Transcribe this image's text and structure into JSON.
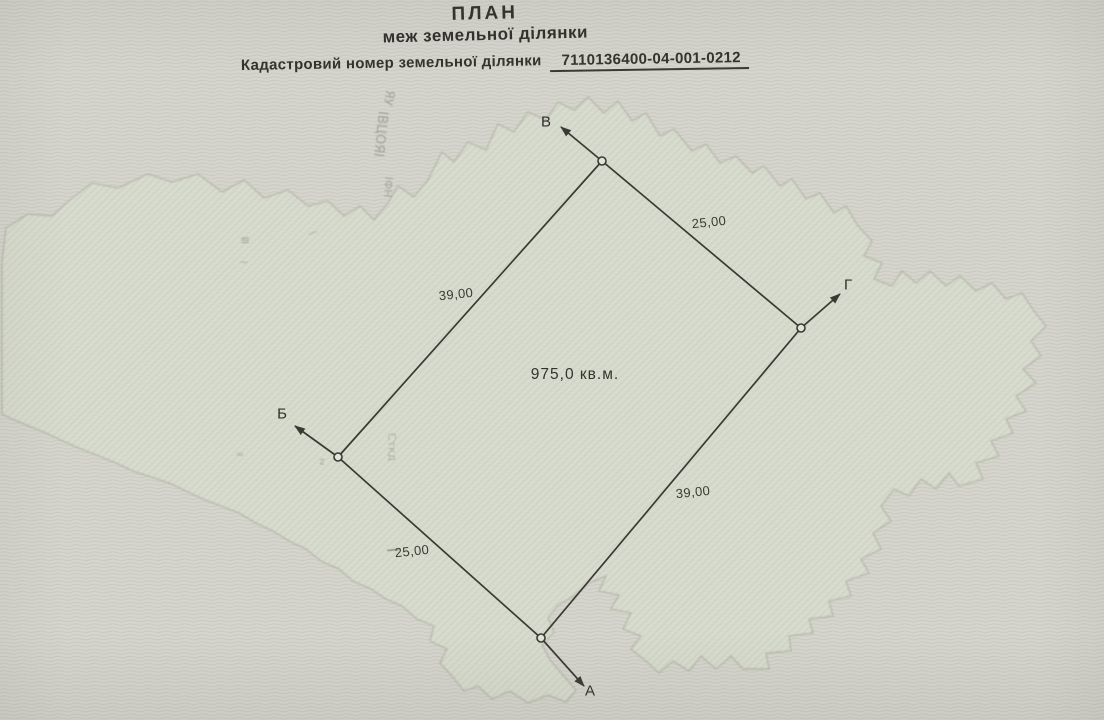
{
  "header": {
    "title": "ПЛАН",
    "subtitle": "меж земельної ділянки",
    "cadastral_label": "Кадастровий номер земельної ділянки",
    "cadastral_number": "7110136400-04-001-0212"
  },
  "plan": {
    "points": [
      {
        "name": "В",
        "x": 602,
        "y": 161,
        "arrow": {
          "x": 561,
          "y": 127
        },
        "label": {
          "x": 546,
          "y": 122
        }
      },
      {
        "name": "Г",
        "x": 801,
        "y": 328,
        "arrow": {
          "x": 840,
          "y": 294
        },
        "label": {
          "x": 848,
          "y": 285
        }
      },
      {
        "name": "А",
        "x": 541,
        "y": 638,
        "arrow": {
          "x": 584,
          "y": 686
        },
        "label": {
          "x": 590,
          "y": 691
        }
      },
      {
        "name": "Б",
        "x": 338,
        "y": 457,
        "arrow": {
          "x": 295,
          "y": 426
        },
        "label": {
          "x": 282,
          "y": 414
        }
      }
    ],
    "side_labels": [
      {
        "text": "39,00",
        "x": 456,
        "y": 294
      },
      {
        "text": "25,00",
        "x": 709,
        "y": 222
      },
      {
        "text": "39,00",
        "x": 693,
        "y": 492
      },
      {
        "text": "25,00",
        "x": 412,
        "y": 551
      }
    ],
    "area": {
      "text": "975,0 кв.м.",
      "x": 575,
      "y": 375
    }
  },
  "scan_artifacts": [
    {
      "text": "ЯУ",
      "x": 389,
      "y": 98,
      "rotate": 100,
      "size": 12,
      "opacity": 0.5
    },
    {
      "text": "ІВЦОЯІ",
      "x": 380,
      "y": 134,
      "rotate": 96,
      "size": 13,
      "opacity": 0.5
    },
    {
      "text": "ІФН",
      "x": 388,
      "y": 187,
      "rotate": 94,
      "size": 11,
      "opacity": 0.45
    },
    {
      "text": "Сткд",
      "x": 392,
      "y": 447,
      "rotate": 88,
      "size": 11,
      "opacity": 0.4
    },
    {
      "text": "≡",
      "x": 245,
      "y": 240,
      "rotate": 0,
      "size": 12,
      "opacity": 0.5
    },
    {
      "text": "—",
      "x": 313,
      "y": 233,
      "rotate": -20,
      "size": 10,
      "opacity": 0.45
    },
    {
      "text": "~",
      "x": 244,
      "y": 262,
      "rotate": 0,
      "size": 11,
      "opacity": 0.4
    },
    {
      "text": "≈",
      "x": 240,
      "y": 455,
      "rotate": 0,
      "size": 10,
      "opacity": 0.4
    },
    {
      "text": "z",
      "x": 322,
      "y": 462,
      "rotate": 0,
      "size": 10,
      "opacity": 0.45
    },
    {
      "text": "—",
      "x": 393,
      "y": 550,
      "rotate": -4,
      "size": 13,
      "opacity": 0.8,
      "color": "#45453f"
    }
  ],
  "colors": {
    "paper": "#d6d5cd",
    "paper_lines": "#c7c6bd",
    "watermark_fill": "#dadecf",
    "watermark_hatch": "#c5cbba",
    "watermark_edge": "#9aa08f",
    "ink": "#3a3a34"
  }
}
